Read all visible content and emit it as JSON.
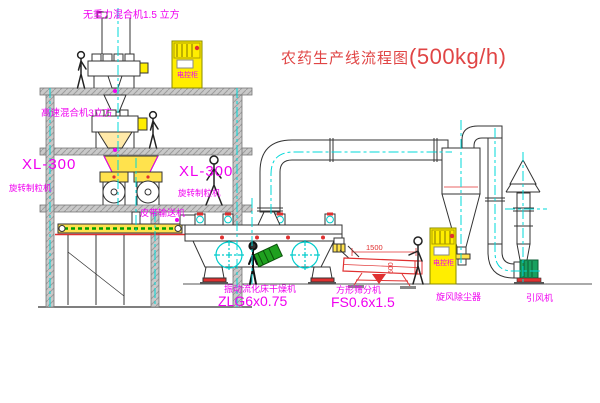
{
  "title": {
    "name": "农药生产线流程图",
    "capacity": "(500kg/h)"
  },
  "labels": {
    "zero_gravity_mixer": "无重力混合机1.5 立方",
    "high_speed_mixer": "高速混合机3立方",
    "granulator_left_model": "XL-300",
    "granulator_left_name": "旋转制粒机",
    "granulator_mid_model": "XL-300",
    "granulator_mid_name": "旋转制粒机",
    "belt_conveyor": "皮带输送机",
    "fluid_bed_dryer": "振动流化床干燥机",
    "fluid_bed_dryer_model": "ZLG6x0.75",
    "square_sieve": "方形筛分机",
    "square_sieve_model": "FS0.6x1.5",
    "cyclone": "旋风除尘器",
    "induced_draft_fan": "引风机",
    "control_cabinet": "电控柜"
  },
  "dimensions": {
    "sieve_length": "1500",
    "sieve_width": "600"
  },
  "colors": {
    "label_magenta": "#f000f0",
    "title_red": "#e04545",
    "drawing_red": "#e03030",
    "centerline_cyan": "#00d8d8",
    "cabinet_yellow": "#ffee00",
    "machine_yellow": "#ffe24d",
    "motor_green": "#18a05f",
    "conveyor_green": "#00a000",
    "structure_grey": "#c9c9c9",
    "line_black": "#333333"
  }
}
